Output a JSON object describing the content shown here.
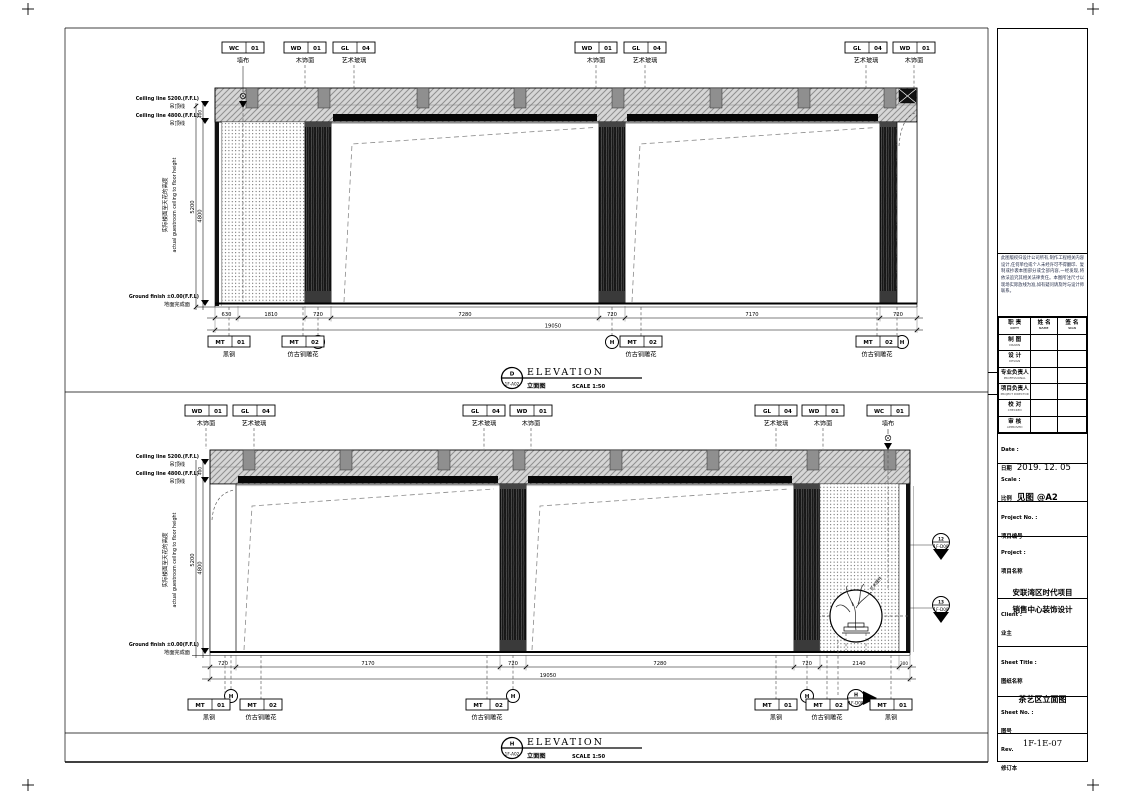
{
  "title_block": {
    "notes": "此图版权归设计公司所有,制作工程相关内容设计,任何单位或个人未经许可不得翻印、复制或抄袭本图部分或全部内容,一经发现,将依法追究其相关法律责任。本图所注尺寸以现场实际放线为准,如有疑问请及时与设计师联系。",
    "table": {
      "headers": [
        {
          "cn": "职 责",
          "en": "DUTY"
        },
        {
          "cn": "姓 名",
          "en": "NAME"
        },
        {
          "cn": "签 名",
          "en": "SIGN"
        }
      ],
      "rows": [
        {
          "cn": "制 图",
          "en": "DRAWN"
        },
        {
          "cn": "设 计",
          "en": "DESIGN"
        },
        {
          "cn": "专业负责人",
          "en": "PROFESSIONAL"
        },
        {
          "cn": "项目负责人",
          "en": "PROJECT DIRECTOR"
        },
        {
          "cn": "校 对",
          "en": "CHECKED"
        },
        {
          "cn": "审 核",
          "en": "APPROVED"
        }
      ]
    },
    "date": {
      "label_en": "Date :",
      "label_cn": "日期",
      "value": "2019. 12. 05"
    },
    "scale": {
      "label_en": "Scale :",
      "label_cn": "比例",
      "value": "见图 @A2"
    },
    "project_no": {
      "label_en": "Project No. :",
      "label_cn": "项目编号"
    },
    "project": {
      "label_en": "Project :",
      "label_cn": "项目名称",
      "line1": "安联湾区时代项目",
      "line2": "销售中心装饰设计"
    },
    "client": {
      "label_en": "Client :",
      "label_cn": "业主"
    },
    "sheet_title": {
      "label_en": "Sheet Title :",
      "label_cn": "图纸名称",
      "value": "茶艺区立面图"
    },
    "sheet_no": {
      "label_en": "Sheet No. :",
      "label_cn": "图号",
      "value": "1F-1E-07"
    },
    "rev": {
      "label_en": "Rev.",
      "label_cn": "修订本"
    }
  },
  "elev1": {
    "top_tags": [
      {
        "code": "WC",
        "num": "01",
        "label": "墙布"
      },
      {
        "code": "WD",
        "num": "01",
        "label": "木饰面"
      },
      {
        "code": "GL",
        "num": "04",
        "label": "艺术玻璃"
      },
      {
        "code": "WD",
        "num": "01",
        "label": "木饰面"
      },
      {
        "code": "GL",
        "num": "04",
        "label": "艺术玻璃"
      },
      {
        "code": "GL",
        "num": "04",
        "label": "艺术玻璃"
      },
      {
        "code": "WD",
        "num": "01",
        "label": "木饰面"
      }
    ],
    "bottom_tags": [
      {
        "code": "MT",
        "num": "01",
        "label": "黑钢"
      },
      {
        "code": "MT",
        "num": "02",
        "label": "仿古铜雕花"
      },
      {
        "code": "MT",
        "num": "02",
        "label": "仿古铜雕花"
      },
      {
        "code": "MT",
        "num": "02",
        "label": "仿古铜雕花"
      }
    ],
    "dims": [
      "630",
      "1810",
      "720",
      "7280",
      "720",
      "7170",
      "720"
    ],
    "total": "19050",
    "v400": "400",
    "v5200": "5200",
    "v4800": "4800",
    "ceiling1_en": "Ceiling line 5200.(F.F.L)",
    "ceiling1_cn": "吊顶线",
    "ceiling2_en": "Ceiling line 4800.(F.F.L)",
    "ceiling2_cn": "吊顶线",
    "ground_en": "Ground finish ±0.00(F.F.L)",
    "ground_cn": "地面完成面",
    "side_cn": "实际楼面至天花的高度",
    "side_en": "actual guestroom ceiling to floor height",
    "grid": "H",
    "title": {
      "letter": "D",
      "ref": "1F-A02",
      "text": "ELEVATION",
      "cn": "立面图",
      "scale": "SCALE 1:50"
    }
  },
  "elev2": {
    "top_tags": [
      {
        "code": "WD",
        "num": "01",
        "label": "木饰面"
      },
      {
        "code": "GL",
        "num": "04",
        "label": "艺术玻璃"
      },
      {
        "code": "GL",
        "num": "04",
        "label": "艺术玻璃"
      },
      {
        "code": "WD",
        "num": "01",
        "label": "木饰面"
      },
      {
        "code": "GL",
        "num": "04",
        "label": "艺术玻璃"
      },
      {
        "code": "WD",
        "num": "01",
        "label": "木饰面"
      },
      {
        "code": "WC",
        "num": "01",
        "label": "墙布"
      }
    ],
    "bottom_tags": [
      {
        "code": "MT",
        "num": "01",
        "label": "黑钢"
      },
      {
        "code": "MT",
        "num": "02",
        "label": "仿古铜雕花"
      },
      {
        "code": "MT",
        "num": "02",
        "label": "仿古铜雕花"
      },
      {
        "code": "MT",
        "num": "01",
        "label": "黑钢"
      },
      {
        "code": "MT",
        "num": "02",
        "label": "仿古铜雕花"
      },
      {
        "code": "MT",
        "num": "01",
        "label": "黑钢"
      }
    ],
    "dims": [
      "720",
      "7170",
      "720",
      "7280",
      "720",
      "2140",
      "300"
    ],
    "total": "19050",
    "v400": "400",
    "v5200": "5200",
    "v4800": "4800",
    "ceiling1_en": "Ceiling line 5200.(F.F.L)",
    "ceiling1_cn": "吊顶线",
    "ceiling2_en": "Ceiling line 4800.(F.F.L)",
    "ceiling2_cn": "吊顶线",
    "ground_en": "Ground finish ±0.00(F.F.L)",
    "ground_cn": "地面完成面",
    "side_cn": "实际楼面至天花的高度",
    "side_en": "actual guestroom ceiling to floor height",
    "grid": "H",
    "art_note": "艺术摆件",
    "markers": [
      {
        "num": "12",
        "ref": "1F-D08"
      },
      {
        "num": "13",
        "ref": "1F-D08"
      }
    ],
    "arrow": {
      "letter": "H",
      "ref": "1F-D08"
    },
    "title": {
      "letter": "H",
      "ref": "1F-A02",
      "text": "ELEVATION",
      "cn": "立面图",
      "scale": "SCALE 1:50"
    }
  }
}
